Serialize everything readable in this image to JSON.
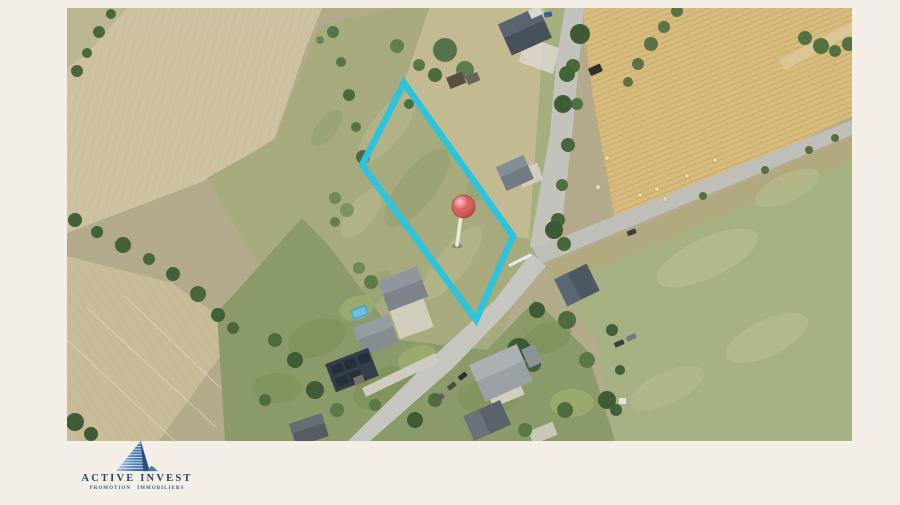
{
  "page": {
    "background_color": "#f4efe6"
  },
  "photo": {
    "alt": "Aerial view of a building plot outlined in turquoise with a red pin marker, surrounded by fields, roads and houses",
    "colors": {
      "plot_outline": "#2cc3dc",
      "pin": "#d84848",
      "pin_needle": "#e8e8e2"
    }
  },
  "branding": {
    "logo_icon": "pyramid-building-icon",
    "name": "ACTIVE INVEST",
    "tagline": "PROMOTION IMMOBILIERS",
    "color": "#24456b"
  }
}
